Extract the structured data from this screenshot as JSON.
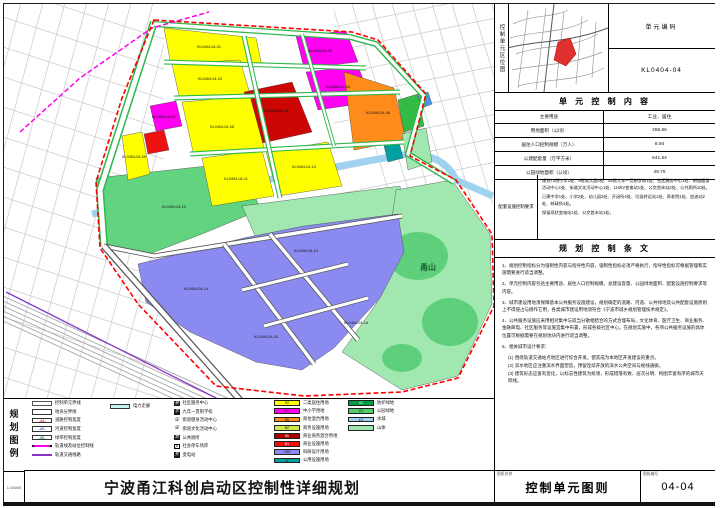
{
  "left_strip": {
    "label": "规划图例",
    "scale": "1:10000"
  },
  "titlebar": {
    "title": "宁波甬江科创启动区控制性详细规划",
    "sheet_name_label": "图纸名称",
    "sheet_name": "控制单元图则",
    "sheet_no_label": "图纸编号",
    "sheet_no": "04-04"
  },
  "unit_location": {
    "side_label": "控制单元区位图",
    "code_label": "单元编码",
    "code": "KL0404-04"
  },
  "unit_content": {
    "header": "单 元 控 制 内 容",
    "rows": [
      {
        "label": "主要用途",
        "value": "工业、居住"
      },
      {
        "label": "用地面积（公顷）",
        "value": "455.66"
      },
      {
        "label": "居住人口控制规模（万人）",
        "value": "8.94"
      },
      {
        "label": "公建配套量（万平方米）",
        "value": "541.54"
      },
      {
        "label": "公园绿地面积（公顷）",
        "value": "49.76"
      }
    ],
    "facility_label": "配套设施\n控制要求",
    "facility_paragraphs": [
      "规划72班小学1处、9班幼儿园3处、54班九年一贯制学校1处、社区服务中心1处、街道健身活动中心1处、街道文化活动中心1处、110kV变电站1处、公交首末站2处、公共厕所10处。",
      "已建中学1处、小学2处、幼儿园3处、开闭所4处、垃圾转运站1处、养老院1处、加油站2处、邮政所1处。",
      "保留现状变电站1处、公交首末站1处。"
    ]
  },
  "provisions": {
    "header": "规 划 控 制 条 文",
    "items": [
      "1、规划控制指标分为强制性内容与指导性内容，强制性指标必须严格执行，指导性指标可根据管理和实施需要进行适当调整。",
      "2、单元控制内容包括主要用途、居住人口控制规模、总建设容量、公园绿地面积、配套设施控制要求等内容。",
      "3、城市建设用地须保障基本公共服务设施建设，规划确定的道路、河道、公共绿地及公共配套设施原则上不得侵占与挪作它用，各类城市建设用地须符合《宁波市城乡规划管理技术规定》。",
      "4、公共服务设施应采用相对集中与适当分散相结合的方式合理布局，文化体育、医疗卫生、商业服务、金融邮电、社区服务等设施宜集中布置，形成各级社区中心。在规划实施中，各项公共服务设施的具体位置可根据需要在规划地块内进行适当调整。",
      "5、相关城市设计要求：\n(1) 围绕轨道交通站点地区进行综合开发，使其成为本地区开发建设的重点。\n(2) 滨水地区应注重滨水界面塑造，预留连续开放的滨水公共空间与视线通廊。\n(3) 建筑形态应富有变化，以标志性建筑为统领，形成错落有致、层次分明、构图丰富有序的城市天际线。"
    ]
  },
  "legend": {
    "lines": [
      {
        "kind": "unit",
        "label": "控制单元界线"
      },
      {
        "kind": "plot",
        "label": "地块分界线"
      },
      {
        "kind": "num",
        "num": "24",
        "color": "#e02020",
        "label": "道路控制宽度"
      },
      {
        "kind": "num",
        "num": "20",
        "color": "#2060e0",
        "label": "河道控制宽度"
      },
      {
        "kind": "num",
        "num": "30",
        "color": "#109030",
        "label": "绿带控制宽度"
      },
      {
        "kind": "railctrl",
        "label": "轨道线及站位控制线"
      },
      {
        "kind": "railline",
        "label": "轨道交通线路"
      }
    ],
    "power": {
      "label": "电力走廊",
      "color": "#c8f2f2"
    },
    "icons": [
      {
        "glyph": "服",
        "style": "dark",
        "label": "社区服务中心"
      },
      {
        "glyph": "学",
        "style": "dark",
        "label": "九年一贯制学校"
      },
      {
        "glyph": "①",
        "style": "circ",
        "label": "街道健身活动中心"
      },
      {
        "glyph": "②",
        "style": "circ",
        "label": "街道文化活动中心"
      },
      {
        "glyph": "厕",
        "style": "dark",
        "label": "公共厕所"
      },
      {
        "glyph": "P",
        "style": "box",
        "label": "社会停车场库"
      },
      {
        "glyph": "变",
        "style": "dark",
        "label": "变电站"
      }
    ],
    "land_a": [
      {
        "code": "R2",
        "color": "#ffff00",
        "label": "二类居住用地"
      },
      {
        "code": "A33",
        "color": "#ff00f0",
        "label": "中小学用地"
      },
      {
        "code": "Rb",
        "color": "#ff8c1a",
        "label": "商住混合用地"
      },
      {
        "code": "B2",
        "color": "#cde84a",
        "label": "商务设施用地"
      },
      {
        "code": "Bb",
        "color": "#aa0000",
        "label": "商业商务混合用地"
      },
      {
        "code": "B1",
        "color": "#ee1111",
        "label": "商业设施用地"
      },
      {
        "code": "C65",
        "color": "#8a8af0",
        "label": "科研设计用地"
      },
      {
        "code": "U",
        "color": "#00a0a0",
        "label": "公用设施用地"
      }
    ],
    "land_b": [
      {
        "code": "G2",
        "color": "#009944",
        "label": "防护绿地"
      },
      {
        "code": "G1",
        "color": "#55cc66",
        "label": "公园绿地"
      },
      {
        "code": "E1",
        "color": "#9fd2ee",
        "label": "水域"
      },
      {
        "code": "",
        "color": "#a0e8b0",
        "label": "山体"
      }
    ]
  },
  "map": {
    "boundary_color": "#ff0000",
    "labels": [
      {
        "x": 205,
        "y": 44,
        "t": "KL0404-04-01"
      },
      {
        "x": 316,
        "y": 48,
        "t": "KL0404-04-02"
      },
      {
        "x": 206,
        "y": 76,
        "t": "KL0404-04-03"
      },
      {
        "x": 334,
        "y": 84,
        "t": "KL0404-04-04"
      },
      {
        "x": 272,
        "y": 108,
        "t": "KL0404-04-05"
      },
      {
        "x": 374,
        "y": 110,
        "t": "KL0404-04-06"
      },
      {
        "x": 160,
        "y": 114,
        "t": "KL0404-04-07"
      },
      {
        "x": 218,
        "y": 124,
        "t": "KL0404-04-08"
      },
      {
        "x": 130,
        "y": 154,
        "t": "KL0404-04-09"
      },
      {
        "x": 300,
        "y": 164,
        "t": "KL0404-04-10"
      },
      {
        "x": 232,
        "y": 176,
        "t": "KL0404-04-11"
      },
      {
        "x": 170,
        "y": 204,
        "t": "KL0404-04-12"
      },
      {
        "x": 302,
        "y": 248,
        "t": "KL0404-04-13"
      },
      {
        "x": 192,
        "y": 286,
        "t": "KL0404-04-14"
      },
      {
        "x": 262,
        "y": 334,
        "t": "KL0404-04-15"
      },
      {
        "x": 352,
        "y": 320,
        "t": "KL0404-04-16"
      },
      {
        "x": 424,
        "y": 266,
        "t": "甬山",
        "big": true
      }
    ]
  }
}
